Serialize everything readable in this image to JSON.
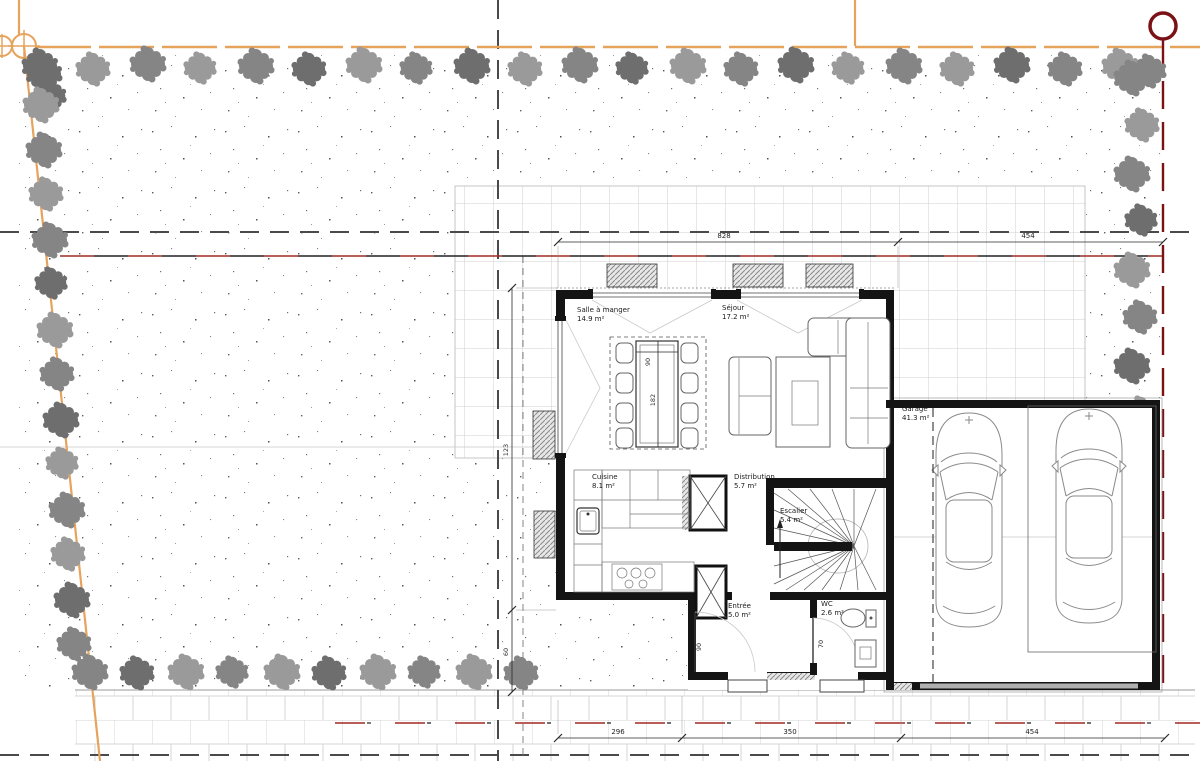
{
  "rooms": [
    {
      "id": "salle-a-manger",
      "name": "Salle à manger",
      "area": "14.9 m²"
    },
    {
      "id": "sejour",
      "name": "Séjour",
      "area": "17.2 m²"
    },
    {
      "id": "cuisine",
      "name": "Cuisine",
      "area": "8.1 m²"
    },
    {
      "id": "distribution",
      "name": "Distribution",
      "area": "5.7 m²"
    },
    {
      "id": "escalier",
      "name": "Escalier",
      "area": "5.4 m²"
    },
    {
      "id": "entree",
      "name": "Entrée",
      "area": "5.0 m²"
    },
    {
      "id": "wc",
      "name": "WC",
      "area": "2.6 m²"
    },
    {
      "id": "garage",
      "name": "Garage",
      "area": "41.3 m²"
    }
  ],
  "dimensions": {
    "top_main": "828",
    "top_garage": "454",
    "bottom_kitchen": "296",
    "bottom_entry": "350",
    "bottom_garage": "454",
    "left_upper": "123",
    "left_lower": "60",
    "table_width": "90",
    "table_depth": "182",
    "door_entry": "90",
    "door_wc": "70"
  },
  "colors": {
    "boundary_orange": "#e6a35c",
    "axis_red": "#a22a22",
    "marker_dark_red": "#7a1216",
    "tree_gray": "#8f8f8f",
    "wall_black": "#141414",
    "dashed_gray": "#4a4a4a"
  }
}
